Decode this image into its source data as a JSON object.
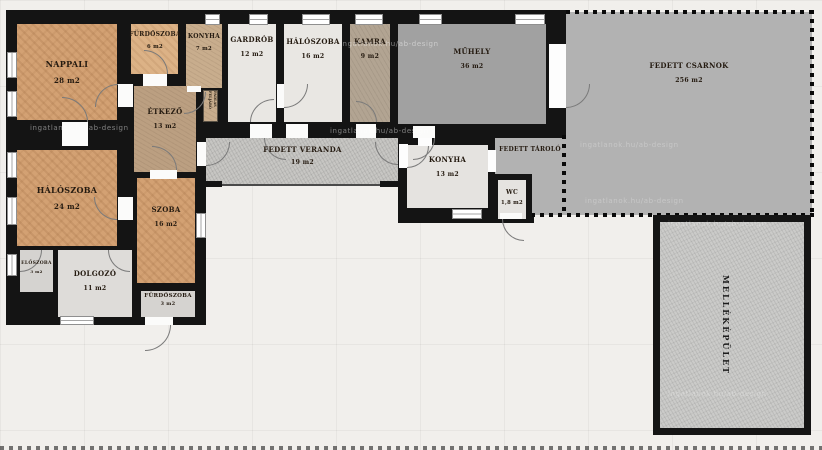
{
  "plan": {
    "type": "floorplan",
    "unit_suffix": "m2",
    "rooms": [
      {
        "name": "NAPPALI",
        "area": "28 m2"
      },
      {
        "name": "FÜRDŐSZOBA",
        "area": "6 m2"
      },
      {
        "name": "KONYHA",
        "area": "7 m2"
      },
      {
        "name": "GARDRÓB",
        "area": "12 m2"
      },
      {
        "name": "HÁLÓSZOBA",
        "area": "16 m2"
      },
      {
        "name": "KAMRA",
        "area": "9 m2"
      },
      {
        "name": "MŰHELY",
        "area": "36 m2"
      },
      {
        "name": "FEDETT CSARNOK",
        "area": "256 m2"
      },
      {
        "name": "ÉTKEZŐ",
        "area": "13 m2"
      },
      {
        "name": "FEDETT VERANDA",
        "area": "19 m2"
      },
      {
        "name": "KONYHA",
        "area": "13 m2"
      },
      {
        "name": "FEDETT TÁROLÓ",
        "area": ""
      },
      {
        "name": "WC",
        "area": "1,8 m2"
      },
      {
        "name": "HÁLÓSZOBA",
        "area": "24 m2"
      },
      {
        "name": "SZOBA",
        "area": "16 m2"
      },
      {
        "name": "ELŐSZOBA",
        "area": "3 m2"
      },
      {
        "name": "DOLGOZÓ",
        "area": "11 m2"
      },
      {
        "name": "FÜRDŐSZOBA",
        "area": "3 m2"
      },
      {
        "name": "MELLÉKÉPÜLET",
        "area": ""
      },
      {
        "name": "PADLÁS FELJÁRÓ",
        "area": ""
      }
    ],
    "watermark": "ingatlanok.hu/ab-design",
    "palette": {
      "wall": "#141414",
      "background": "#f1efec",
      "parquet_tan": "#d3a173",
      "room_white": "#e9e7e3",
      "workshop_gray": "#a1a1a1",
      "hall_gray": "#b2b2b2",
      "veranda_gray": "#c7c6c3",
      "dining_brown": "#bb9f81",
      "pantry_taupe": "#b2a492"
    }
  }
}
